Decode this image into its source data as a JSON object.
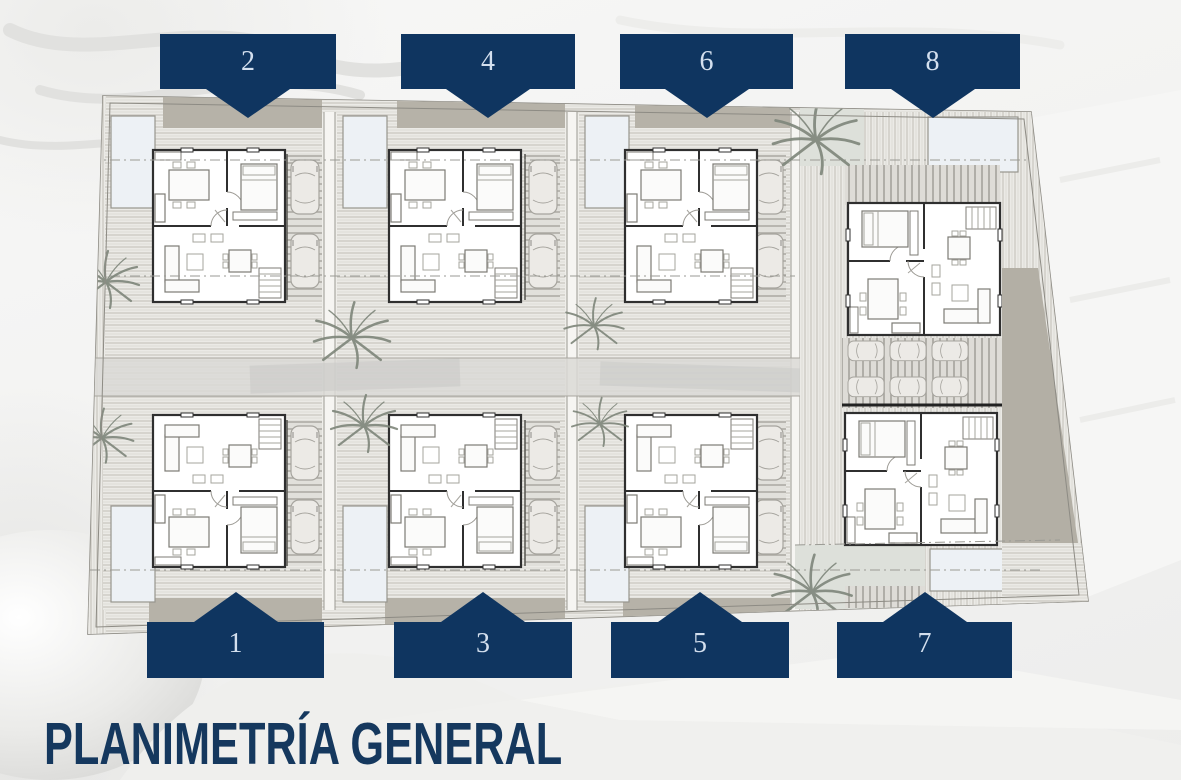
{
  "title": {
    "text": "PLANIMETRÍA GENERAL"
  },
  "plan": {
    "description": "site plan with 8 villa units in two rows",
    "units": [
      {
        "number": "1",
        "row": "bottom"
      },
      {
        "number": "2",
        "row": "top"
      },
      {
        "number": "3",
        "row": "bottom"
      },
      {
        "number": "4",
        "row": "top"
      },
      {
        "number": "5",
        "row": "bottom"
      },
      {
        "number": "6",
        "row": "top"
      },
      {
        "number": "7",
        "row": "bottom"
      },
      {
        "number": "8",
        "row": "top"
      }
    ]
  },
  "colors": {
    "tag_navy": "#0f3560",
    "tag_number": "#d3dfee",
    "title_navy": "#15385e",
    "band_beige": "#b6b2a8",
    "pool_blue": "#edf1f5",
    "patio_sage": "#dde0da",
    "deck_hatch": "#c4c2bb",
    "plan_base": "#efeeea"
  }
}
